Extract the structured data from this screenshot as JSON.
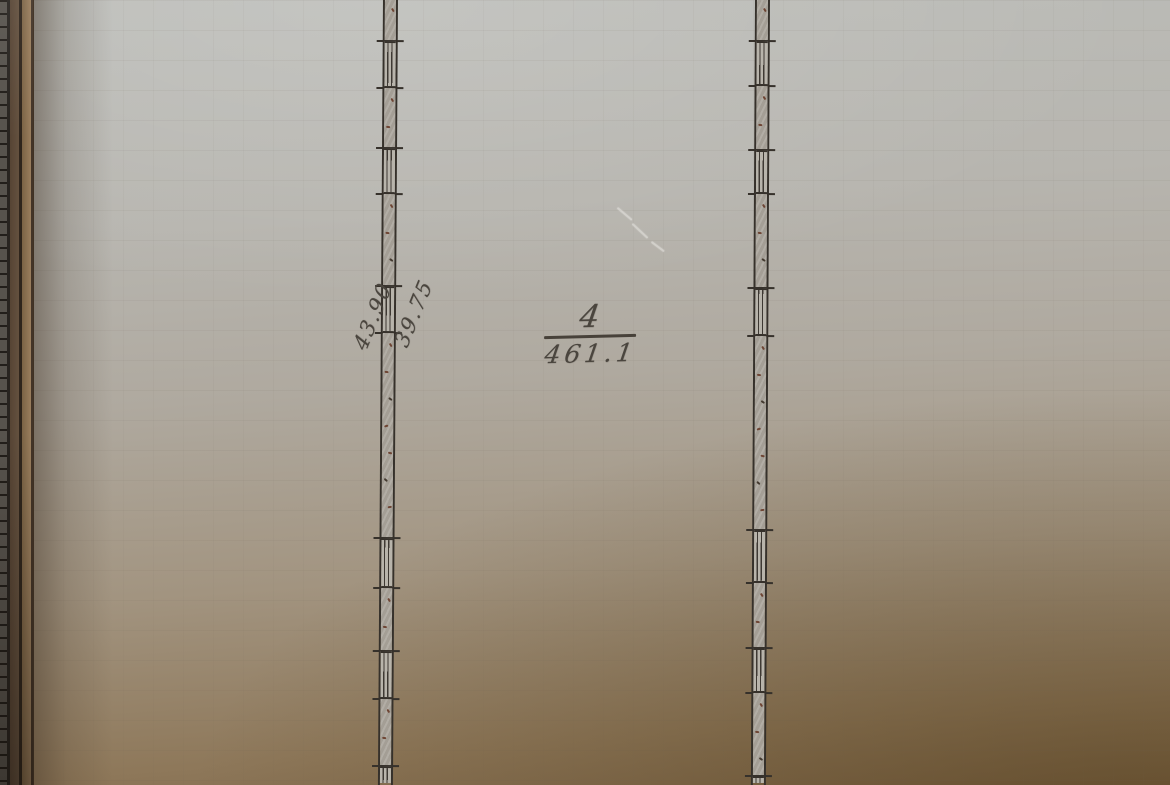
{
  "annotations": {
    "dim_outer": "43.90",
    "dim_inner": "39.75",
    "room_number": "4",
    "room_area": "461.1"
  },
  "drawing": {
    "walls": [
      {
        "name": "left-wall",
        "x": 383,
        "tilt_deg": 0.37,
        "segments": [
          [
            "solid",
            43
          ],
          [
            "window",
            47
          ],
          [
            "solid",
            60
          ],
          [
            "window",
            46
          ],
          [
            "solid",
            92
          ],
          [
            "window",
            47
          ],
          [
            "solid",
            205
          ],
          [
            "window",
            50
          ],
          [
            "solid",
            63
          ],
          [
            "window",
            48
          ],
          [
            "solid",
            67
          ],
          [
            "window",
            17
          ]
        ]
      },
      {
        "name": "right-wall",
        "x": 755,
        "tilt_deg": 0.3,
        "segments": [
          [
            "solid",
            43
          ],
          [
            "window",
            45
          ],
          [
            "solid",
            64
          ],
          [
            "window",
            44
          ],
          [
            "solid",
            94
          ],
          [
            "window",
            48
          ],
          [
            "solid",
            194
          ],
          [
            "window",
            53
          ],
          [
            "solid",
            65
          ],
          [
            "window",
            45
          ],
          [
            "solid",
            83
          ],
          [
            "window",
            7
          ]
        ]
      }
    ]
  },
  "colors": {
    "ink_line": "#36312b",
    "pencil_text": "#4a453e",
    "wall_fill": "#a9a49b",
    "window_fill": "#b8b4ab",
    "hatch_speck": "#6e4534",
    "hatch_speck_dark": "#443a30",
    "paper_top": "#bcbdb9",
    "paper_bottom": "#7f684a",
    "cover_brown": "#5f4c3b"
  }
}
